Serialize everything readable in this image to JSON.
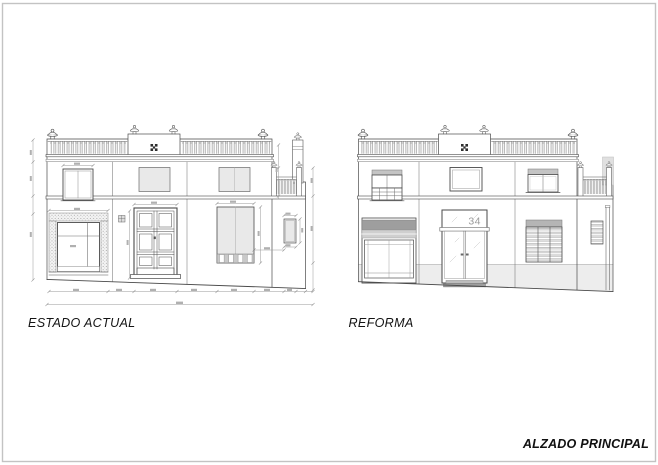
{
  "sheet": {
    "title": "ALZADO PRINCIPAL",
    "background": "#ffffff",
    "border_color": "#c3c3c3"
  },
  "door_number": "34",
  "elevations": [
    {
      "label": "ESTADO ACTUAL",
      "elements": [
        "roof-parapet-balustrade",
        "parapet-finials",
        "parapet-emblem",
        "upper-floor-windows",
        "side-terrace-railing",
        "chimney",
        "shop-opening-textured-surround",
        "panel-entrance-door",
        "shuttered-opening",
        "small-window",
        "dimension-lines",
        "sloping-ground-line"
      ]
    },
    {
      "label": "REFORMA",
      "elements": [
        "roof-parapet-balustrade",
        "parapet-finials",
        "parapet-emblem",
        "balcony-window-with-railing",
        "upper-floor-windows",
        "side-terrace-railing",
        "chimney",
        "shopfront-with-awning-box",
        "glazed-double-door",
        "louvered-window",
        "small-louver-vent",
        "downpipe",
        "plinth-band",
        "sloping-ground-line"
      ]
    }
  ],
  "colors": {
    "line": "#4a4a4a",
    "dimension": "#989898",
    "glass": "#e9e9e9",
    "awning_dark": "#9e9e9e",
    "awning_mid": "#cfcfcf",
    "plinth": "#ededed",
    "emblem": "#2e2e2e"
  }
}
